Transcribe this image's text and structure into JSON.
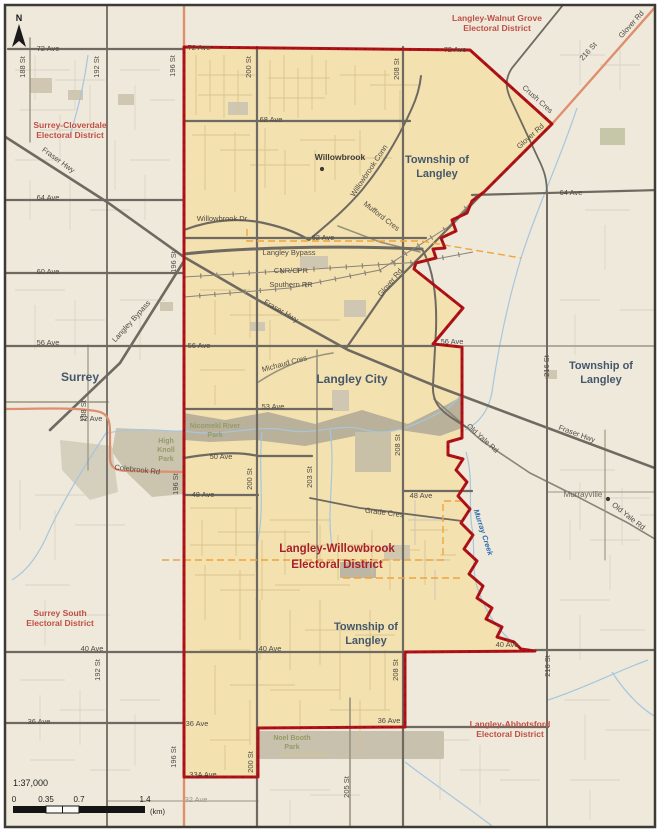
{
  "map": {
    "district_name": "Langley-Willowbrook Electoral District",
    "scale_ratio": "1:37,000"
  },
  "north": {
    "label": "N"
  },
  "scalebar": {
    "ratio": "1:37,000",
    "ticks": [
      "0",
      "0.35",
      "0.7",
      "1.4"
    ],
    "unit": "(km)"
  },
  "colors": {
    "outside_fill": "#EFE9DB",
    "district_fill": "#F3E1B0",
    "boundary_red": "#B01217",
    "road_major_gray": "#6F6A61",
    "road_salmon": "#DE8F6E",
    "creek_blue": "#A6C6DE",
    "municipal_dash_orange": "#F0A43C",
    "district_label_red": "#A91F27",
    "neighbor_label_red": "#BF4F45",
    "municipality_label_blue": "#44576B",
    "park_label_green": "#939C68"
  },
  "points": [
    {
      "n": "willowbrook-dot",
      "x": 322,
      "y": 169
    },
    {
      "n": "murrayville-dot",
      "x": 608,
      "y": 499
    }
  ],
  "labels": [
    {
      "n": "72-ave-w",
      "t": "72 Ave",
      "x": 48,
      "y": 51,
      "c": "road"
    },
    {
      "n": "72-ave-m",
      "t": "72 Ave",
      "x": 199,
      "y": 50,
      "c": "road"
    },
    {
      "n": "72-ave-e",
      "t": "72 Ave",
      "x": 455,
      "y": 52,
      "c": "road"
    },
    {
      "n": "188-st-top",
      "t": "188 St",
      "x": 25,
      "y": 67,
      "r": -90,
      "c": "road"
    },
    {
      "n": "192-st-top",
      "t": "192 St",
      "x": 99,
      "y": 67,
      "r": -90,
      "c": "road"
    },
    {
      "n": "196-st-top",
      "t": "196 St",
      "x": 175,
      "y": 66,
      "r": -90,
      "c": "road"
    },
    {
      "n": "200-st-top",
      "t": "200 St",
      "x": 251,
      "y": 67,
      "r": -90,
      "c": "road"
    },
    {
      "n": "208-st-top",
      "t": "208 St",
      "x": 399,
      "y": 69,
      "r": -90,
      "c": "road"
    },
    {
      "n": "216-st-diag",
      "t": "216 St",
      "x": 590,
      "y": 53,
      "r": -48,
      "c": "road"
    },
    {
      "n": "glover-rd-ne",
      "t": "Glover Rd",
      "x": 633,
      "y": 26,
      "r": -48,
      "c": "road"
    },
    {
      "n": "lwg-district-1",
      "t": "Langley-Walnut Grove",
      "x": 497,
      "y": 21,
      "c": "district"
    },
    {
      "n": "lwg-district-2",
      "t": "Electoral District",
      "x": 497,
      "y": 31,
      "c": "district"
    },
    {
      "n": "sc-district-1",
      "t": "Surrey-Cloverdale",
      "x": 70,
      "y": 128,
      "c": "district"
    },
    {
      "n": "sc-district-2",
      "t": "Electoral District",
      "x": 70,
      "y": 138,
      "c": "district"
    },
    {
      "n": "68-ave",
      "t": "68 Ave",
      "x": 271,
      "y": 122,
      "c": "road"
    },
    {
      "n": "willowbrook",
      "t": "Willowbrook",
      "x": 340,
      "y": 160,
      "c": "place"
    },
    {
      "n": "tol-north-1",
      "t": "Township of",
      "x": 437,
      "y": 163,
      "c": "muni"
    },
    {
      "n": "tol-north-2",
      "t": "Langley",
      "x": 437,
      "y": 177,
      "c": "muni"
    },
    {
      "n": "crush-cres",
      "t": "Crush Cres",
      "x": 536,
      "y": 101,
      "r": 42,
      "c": "road"
    },
    {
      "n": "glover-rd-mid",
      "t": "Glover Rd",
      "x": 532,
      "y": 138,
      "r": -42,
      "c": "road"
    },
    {
      "n": "64-ave-w",
      "t": "64 Ave",
      "x": 48,
      "y": 200,
      "c": "road"
    },
    {
      "n": "64-ave-e",
      "t": "64 Ave",
      "x": 571,
      "y": 195,
      "c": "road"
    },
    {
      "n": "fraser-hwy-w",
      "t": "Fraser Hwy",
      "x": 57,
      "y": 162,
      "r": 36,
      "c": "road"
    },
    {
      "n": "willowbrook-conn",
      "t": "Willowbrook Conn",
      "x": 371,
      "y": 172,
      "r": -56,
      "c": "road"
    },
    {
      "n": "willowbrook-dr",
      "t": "Willowbrook Dr",
      "x": 222,
      "y": 221,
      "c": "road"
    },
    {
      "n": "mufford-cres",
      "t": "Mufford Cres",
      "x": 380,
      "y": 218,
      "r": 38,
      "c": "road"
    },
    {
      "n": "62-ave",
      "t": "62 Ave",
      "x": 323,
      "y": 240,
      "c": "road"
    },
    {
      "n": "langley-bypass-h",
      "t": "Langley Bypass",
      "x": 289,
      "y": 255,
      "c": "road"
    },
    {
      "n": "cnr-cpr",
      "t": "CNR/CPR",
      "x": 291,
      "y": 273,
      "c": "road"
    },
    {
      "n": "southern-rr",
      "t": "Southern RR",
      "x": 291,
      "y": 287,
      "c": "road"
    },
    {
      "n": "60-ave",
      "t": "60 Ave",
      "x": 48,
      "y": 274,
      "c": "road"
    },
    {
      "n": "196-st-mid",
      "t": "196 St",
      "x": 176,
      "y": 262,
      "r": -90,
      "c": "road"
    },
    {
      "n": "glover-rd-city",
      "t": "Glover Rd",
      "x": 392,
      "y": 284,
      "r": -50,
      "c": "road"
    },
    {
      "n": "fraser-hwy-m",
      "t": "Fraser Hwy",
      "x": 280,
      "y": 313,
      "r": 30,
      "c": "road"
    },
    {
      "n": "langley-bypass-d",
      "t": "Langley Bypass",
      "x": 133,
      "y": 323,
      "r": -48,
      "c": "road"
    },
    {
      "n": "56-ave-w",
      "t": "56 Ave",
      "x": 48,
      "y": 345,
      "c": "road"
    },
    {
      "n": "56-ave-m",
      "t": "56 Ave",
      "x": 199,
      "y": 348,
      "c": "road"
    },
    {
      "n": "56-ave-e",
      "t": "56 Ave",
      "x": 452,
      "y": 344,
      "c": "road"
    },
    {
      "n": "216-st-mid",
      "t": "216 St",
      "x": 549,
      "y": 366,
      "r": -90,
      "c": "road"
    },
    {
      "n": "tol-east-1",
      "t": "Township of",
      "x": 601,
      "y": 369,
      "c": "muni"
    },
    {
      "n": "tol-east-2",
      "t": "Langley",
      "x": 601,
      "y": 383,
      "c": "muni"
    },
    {
      "n": "surrey",
      "t": "Surrey",
      "x": 80,
      "y": 381,
      "c": "muni-lg"
    },
    {
      "n": "michaud-cres",
      "t": "Michaud Cres",
      "x": 285,
      "y": 366,
      "r": -15,
      "c": "road"
    },
    {
      "n": "langley-city",
      "t": "Langley City",
      "x": 352,
      "y": 383,
      "c": "muni-lg"
    },
    {
      "n": "53-ave",
      "t": "53 Ave",
      "x": 273,
      "y": 409,
      "c": "road"
    },
    {
      "n": "52-ave",
      "t": "52 Ave",
      "x": 91,
      "y": 421,
      "c": "road"
    },
    {
      "n": "nicomekl-park-1",
      "t": "Nicomekl River",
      "x": 215,
      "y": 428,
      "c": "park"
    },
    {
      "n": "nicomekl-park-2",
      "t": "Park",
      "x": 215,
      "y": 437,
      "c": "park"
    },
    {
      "n": "high-knoll-1",
      "t": "High",
      "x": 166,
      "y": 443,
      "c": "park"
    },
    {
      "n": "high-knoll-2",
      "t": "Knoll",
      "x": 166,
      "y": 452,
      "c": "park"
    },
    {
      "n": "high-knoll-3",
      "t": "Park",
      "x": 166,
      "y": 461,
      "c": "park"
    },
    {
      "n": "colebrook-rd",
      "t": "Colebrook Rd",
      "x": 137,
      "y": 472,
      "r": 6,
      "c": "road"
    },
    {
      "n": "50-ave",
      "t": "50 Ave",
      "x": 221,
      "y": 459,
      "c": "road"
    },
    {
      "n": "188-st-mid",
      "t": "188 St",
      "x": 86,
      "y": 411,
      "r": -90,
      "c": "road"
    },
    {
      "n": "196-st-low",
      "t": "196 St",
      "x": 178,
      "y": 484,
      "r": -90,
      "c": "road"
    },
    {
      "n": "200-st-mid",
      "t": "200 St",
      "x": 252,
      "y": 479,
      "r": -90,
      "c": "road"
    },
    {
      "n": "203-st",
      "t": "203 St",
      "x": 312,
      "y": 477,
      "r": -90,
      "c": "road"
    },
    {
      "n": "208-st-mid",
      "t": "208 St",
      "x": 400,
      "y": 445,
      "r": -90,
      "c": "road"
    },
    {
      "n": "48-ave-w",
      "t": "48 Ave",
      "x": 203,
      "y": 497,
      "c": "road"
    },
    {
      "n": "48-ave-e",
      "t": "48 Ave",
      "x": 421,
      "y": 498,
      "c": "road"
    },
    {
      "n": "old-yale-rd-1",
      "t": "Old Yale Rd",
      "x": 481,
      "y": 440,
      "r": 42,
      "c": "road"
    },
    {
      "n": "fraser-hwy-e",
      "t": "Fraser Hwy",
      "x": 576,
      "y": 436,
      "r": 20,
      "c": "road"
    },
    {
      "n": "murrayville",
      "t": "Murrayville",
      "x": 583,
      "y": 497,
      "c": "place-sm"
    },
    {
      "n": "old-yale-rd-2",
      "t": "Old Yale Rd",
      "x": 627,
      "y": 518,
      "r": 38,
      "c": "road"
    },
    {
      "n": "grade-cres",
      "t": "Grade Cres",
      "x": 384,
      "y": 515,
      "r": 7,
      "c": "road"
    },
    {
      "n": "murray-creek",
      "t": "Murray Creek",
      "x": 481,
      "y": 533,
      "r": 72,
      "c": "creek"
    },
    {
      "n": "lw-district-1",
      "t": "Langley-Willowbrook",
      "x": 337,
      "y": 552,
      "c": "district-main"
    },
    {
      "n": "lw-district-2",
      "t": "Electoral District",
      "x": 337,
      "y": 568,
      "c": "district-main"
    },
    {
      "n": "ss-district-1",
      "t": "Surrey South",
      "x": 60,
      "y": 616,
      "c": "district"
    },
    {
      "n": "ss-district-2",
      "t": "Electoral District",
      "x": 60,
      "y": 626,
      "c": "district"
    },
    {
      "n": "tol-south-1",
      "t": "Township of",
      "x": 366,
      "y": 630,
      "c": "muni"
    },
    {
      "n": "tol-south-2",
      "t": "Langley",
      "x": 366,
      "y": 644,
      "c": "muni"
    },
    {
      "n": "40-ave-w",
      "t": "40 Ave",
      "x": 92,
      "y": 651,
      "c": "road"
    },
    {
      "n": "40-ave-m",
      "t": "40 Ave",
      "x": 270,
      "y": 651,
      "c": "road"
    },
    {
      "n": "40-ave-e",
      "t": "40 Ave",
      "x": 507,
      "y": 647,
      "c": "road"
    },
    {
      "n": "192-st-low",
      "t": "192 St",
      "x": 100,
      "y": 670,
      "r": -90,
      "c": "road"
    },
    {
      "n": "208-st-low",
      "t": "208 St",
      "x": 398,
      "y": 670,
      "r": -90,
      "c": "road"
    },
    {
      "n": "216-st-low",
      "t": "216 St",
      "x": 550,
      "y": 666,
      "r": -90,
      "c": "road"
    },
    {
      "n": "36-ave-w",
      "t": "36 Ave",
      "x": 39,
      "y": 724,
      "c": "road"
    },
    {
      "n": "36-ave-m",
      "t": "36 Ave",
      "x": 197,
      "y": 726,
      "c": "road"
    },
    {
      "n": "36-ave-e",
      "t": "36 Ave",
      "x": 389,
      "y": 723,
      "c": "road"
    },
    {
      "n": "la-district-1",
      "t": "Langley-Abbotsford",
      "x": 510,
      "y": 727,
      "c": "district"
    },
    {
      "n": "la-district-2",
      "t": "Electoral District",
      "x": 510,
      "y": 737,
      "c": "district"
    },
    {
      "n": "noel-booth-1",
      "t": "Noel Booth",
      "x": 292,
      "y": 740,
      "c": "park"
    },
    {
      "n": "noel-booth-2",
      "t": "Park",
      "x": 292,
      "y": 749,
      "c": "park"
    },
    {
      "n": "196-st-bot",
      "t": "196 St",
      "x": 176,
      "y": 757,
      "r": -90,
      "c": "road"
    },
    {
      "n": "200-st-bot",
      "t": "200 St",
      "x": 253,
      "y": 762,
      "r": -90,
      "c": "road"
    },
    {
      "n": "205-st",
      "t": "205 St",
      "x": 349,
      "y": 787,
      "r": -90,
      "c": "road"
    },
    {
      "n": "33a-ave",
      "t": "33A Ave",
      "x": 203,
      "y": 777,
      "c": "road"
    },
    {
      "n": "32-ave",
      "t": "32 Ave",
      "x": 196,
      "y": 802,
      "c": "road-light"
    }
  ]
}
